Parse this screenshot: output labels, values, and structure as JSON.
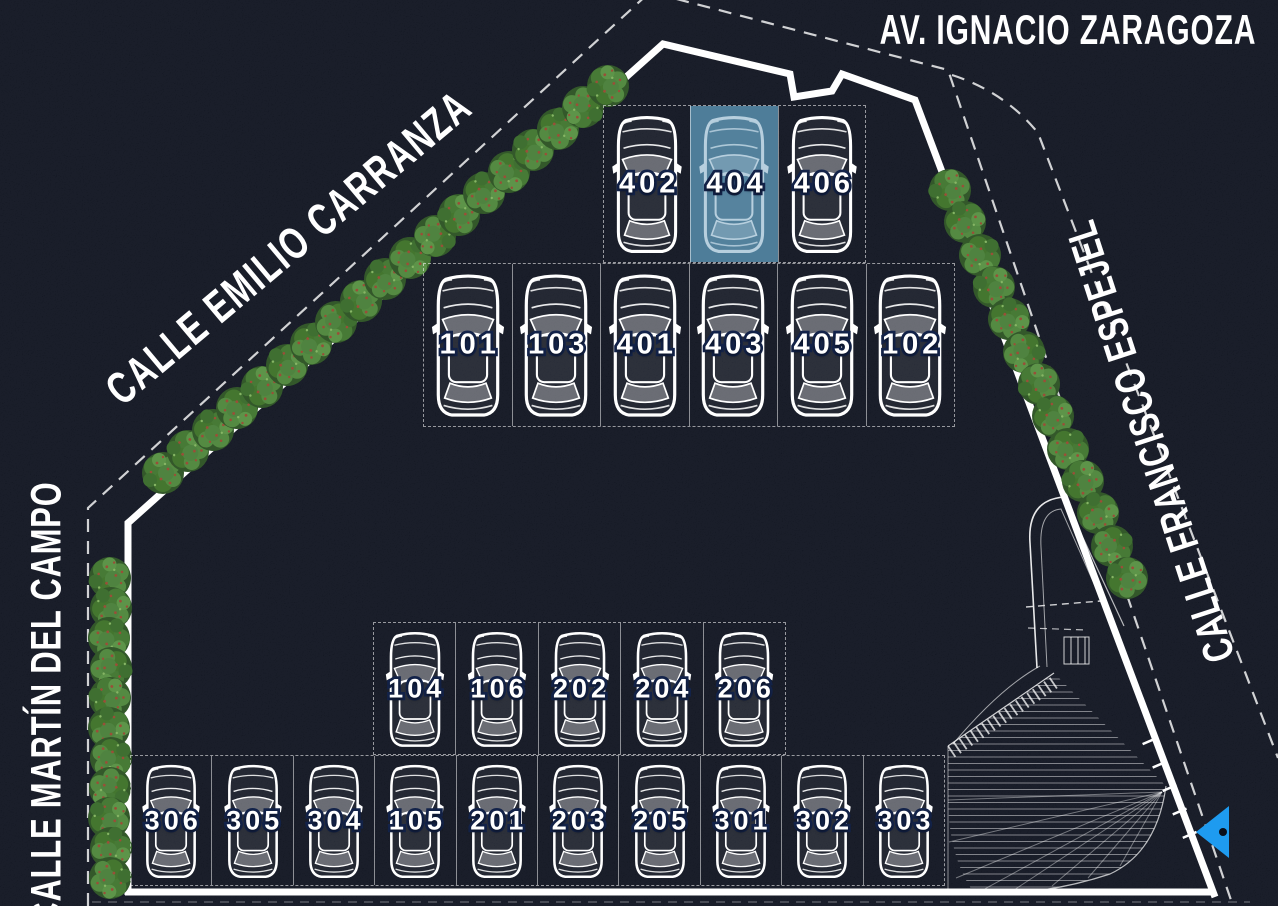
{
  "site_plan": {
    "streets": {
      "top": "AV. IGNACIO ZARAGOZA",
      "northwest": "CALLE EMILIO CARRANZA",
      "east": "CALLE FRANCISCO ESPEJEL",
      "west": "CALLE MARTÍN DEL CAMPO"
    },
    "parking_rows": [
      {
        "id": "row-top",
        "spaces": [
          "402",
          "404",
          "406"
        ]
      },
      {
        "id": "row-upper",
        "spaces": [
          "101",
          "103",
          "401",
          "403",
          "405",
          "102"
        ]
      },
      {
        "id": "row-middle",
        "spaces": [
          "104",
          "106",
          "202",
          "204",
          "206"
        ]
      },
      {
        "id": "row-bottom",
        "spaces": [
          "306",
          "305",
          "304",
          "105",
          "201",
          "203",
          "205",
          "301",
          "302",
          "303"
        ]
      }
    ],
    "highlighted_space": "404",
    "icons": {
      "entrance_arrow": "left-arrow",
      "trees": "tree",
      "cars": "car-top-view"
    },
    "colors": {
      "background": "#0a0e19",
      "line_white": "#ffffff",
      "highlight_fill": "#4e7d99",
      "highlight_car_line": "#b7cfde",
      "number_fill": "#ffffff",
      "number_outline": "#13234a",
      "tree_green": "#4a7d3a",
      "arrow_blue": "#1e9bf0"
    }
  }
}
